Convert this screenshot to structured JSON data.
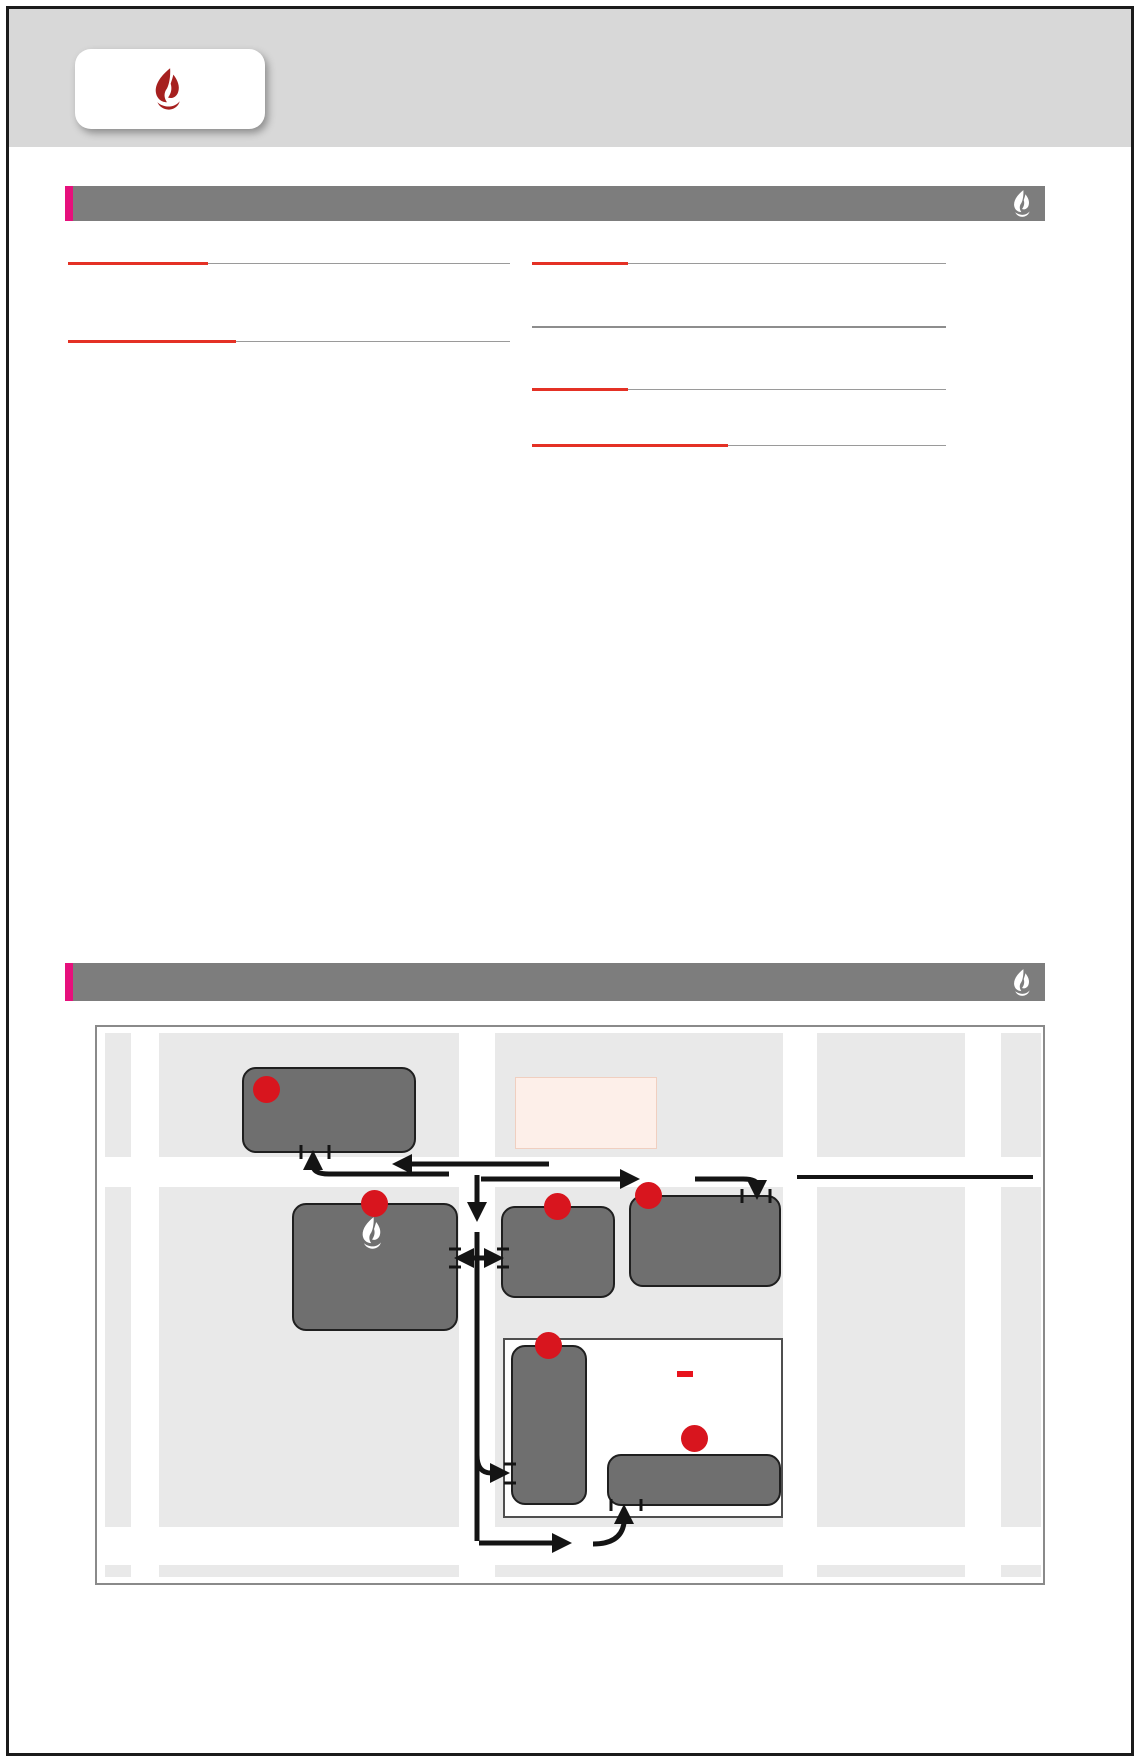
{
  "header": {
    "logo_text": "교회안내",
    "church_name": "LA SA-RANG COMMUNITY CHURCH"
  },
  "staff": {
    "title": "사역자 안내",
    "sep": "/",
    "left_groups": [
      {
        "heading": "장년사역",
        "rows": [
          {
            "name": "최금석 목사",
            "phone": "213-952-2405",
            "roles": "선임, 교구, 차세대총괄, 권사회, 선교, MTS"
          },
          {
            "name": "신범수 목사",
            "phone": "424-241-8239",
            "roles": "교구, 새가족, 훈련, 성경방, 주차/시설"
          },
          {
            "name": "황성실 목사",
            "phone": "213-235-8631",
            "roles": "교구, 실버, 찬양(대), 주방, 중보기도"
          },
          {
            "name": "김민기 목사",
            "phone": "714-497-7065",
            "roles": "대청부, 예배, 멀티미디어, LMD, 가정"
          },
          {
            "name": "김숙영 전도사",
            "phone": "909-802-0580",
            "roles": "교구, 에즈마이야, 새가족, 이웃사랑, 전도, Youth 디렉터"
          }
        ]
      },
      {
        "heading": "차세대사역",
        "rows": [
          {
            "name": "김크리스 전도사",
            "phone": "510-304-3968",
            "roles": "MTS, 에즈마이야, 고등부"
          },
          {
            "name": "조크리스 전도사",
            "phone": "503-810-8162",
            "roles": "MTS, 중등부"
          },
          {
            "name": "이옥희 전도사",
            "phone": "213-273-5534",
            "roles": "초등부, 학교총괄, CM디렉터"
          },
          {
            "name": "이희성 전도사",
            "phone": "213-999-1847",
            "roles": "유치부, 사랑토요한글/뮤직아트스쿨"
          },
          {
            "name": "송혜진 디렉터",
            "phone": "213-220-1853",
            "roles": "유아부"
          },
          {
            "name": "손이사야 전도사",
            "phone": "213-598-9987",
            "roles": "MTS, 차세대 인턴"
          },
          {
            "name": "한성준 전도사",
            "phone": "213-254-8592",
            "roles": "MTS, 차세대 인턴"
          }
        ]
      }
    ],
    "right_group": {
      "heading": "협동목사",
      "rows": [
        {
          "name": "이해룡 목사",
          "phone": "310-527-1488",
          "roles": "신학교사역"
        },
        {
          "name": "송성엽 목사",
          "phone": "213-370-7707",
          "roles": "가정, 커뮤니티"
        },
        {
          "name": "윤상운 목사",
          "phone": "213-378-7714",
          "roles": ""
        }
      ]
    },
    "retired": {
      "heading": "은퇴전도사",
      "name": "우완재 전도사",
      "phone": "213-248-1929"
    },
    "support": {
      "heading": "목회지원",
      "rows": [
        {
          "name": "이재영",
          "phone": "714-720-5113",
          "roles": "목지실, 사랑아카데미, 에즈마이야"
        },
        {
          "name": "전경희",
          "phone": "213-364-3939",
          "roles": "그래픽 디자인"
        },
        {
          "name": "박　준",
          "phone": "213-718-1445",
          "roles": "음향"
        }
      ]
    },
    "academy": {
      "heading": "LA사랑아카데미",
      "website": "www.MYsarang.com",
      "joiner": "–",
      "rows": [
        {
          "label": "학교 총괄 디렉터",
          "value": "이옥희 전도사  213-273-5534"
        },
        {
          "label": "토요한글학교 / 뮤직아트스쿨",
          "value": "이희성 전도사  213-999-1847"
        },
        {
          "label": "썸머/윈터/K~5 애프터스쿨",
          "value": "최영미 원장  323-652-0999"
        }
      ]
    }
  },
  "directions": {
    "title": "주일 예배 장소 오시는 길",
    "venue": "〈사랑올림픽센터〉",
    "address": "2610 W. Olympic Blvd., Los Angeles CA 90006",
    "corner_note": "(올림픽과 엘덴 코너)"
  },
  "map": {
    "streets": {
      "olympic": "Olympic Blvd",
      "elden": "Elden Ave",
      "vermont": "Vermont Ave",
      "hoover": "Hoover St",
      "eleventh": "11st ST."
    },
    "landmarks": {
      "tgi": "TGI BBQ",
      "school_line1": "Leo Politi",
      "school_line2": "Elementary School",
      "school_tag": "※ 시큐리티 상주"
    },
    "addr_labels": {
      "box4": "(2605 W. Olympic Bl.)",
      "box1": "(2610 W. Olympic Bl.)",
      "box2": "(2580 W. Olympic Bl.)",
      "box3": "(2560 W. Olympic Bl.)"
    },
    "boxes": {
      "b4": {
        "num": "4",
        "title": "에덴자동차 주차장",
        "lines": [
          "※ 주일 오전 6시 45분 ~",
          "오후1시 30분 (시큐리티 상주)"
        ]
      },
      "b1": {
        "num": "1",
        "title1": "LA사랑의교회",
        "title2": "주차장",
        "lines": [
          "※ OPEN",
          "<새가족, 시니어, 장애우,",
          "유모차동반차량 Only>"
        ]
      },
      "b2": {
        "num": "2",
        "title": "삼호관광",
        "lines": [
          "※ 주일 오전 7시 ~",
          "오전 11시까지 사용"
        ]
      },
      "b3": {
        "num": "3",
        "title1": "삼호관광 옆",
        "title2": "주차빌딩",
        "lines": [
          "(주일 오전 7시 ~ 오후 5시",
          "시큐리티 상주)"
        ]
      },
      "b5": {
        "num": "5",
        "bold_lines": [
          "Leo Politi",
          "초등학교",
          "주차장"
        ],
        "lines": [
          "<주일>",
          "8:45am ~",
          "1:30pm)"
        ]
      },
      "b6": {
        "num": "6",
        "title": "Leo Politi 초등학교 주차장",
        "line": "<주일> 8:45am ~ 1:30pm)"
      }
    }
  },
  "footer": {
    "title": "〈주차장 사용시간 안내〉",
    "bullet": "•",
    "lines": [
      {
        "entries": [
          {
            "badges": [
              "1"
            ],
            "label": "사랑올림픽센터 교회주차장 〈Open〉",
            "time": ""
          },
          {
            "badges": [
              "2"
            ],
            "label": "삼호관광 〈주일〉",
            "time": "오전 7시 ~ 오전 11시"
          }
        ]
      },
      {
        "entries": [
          {
            "badges": [
              "3"
            ],
            "label": "주차빌딩 〈주일〉",
            "time": "오전 7시 ~ 오후 5시"
          },
          {
            "badges": [
              "4"
            ],
            "label": "에덴자동차 〈주일〉",
            "time": "오전 6시 45분 ~ 오후 1시 30분 사용"
          }
        ]
      },
      {
        "entries": [
          {
            "badges": [
              "5",
              "6"
            ],
            "label": "Leo Politi 초등학교 주차장 〈주일〉",
            "time": "오전 8시 45분 ~ 오후 1시 30분"
          }
        ]
      }
    ]
  },
  "colors": {
    "header_gray": "#d8d8d8",
    "bar_gray": "#7d7d7d",
    "accent_magenta": "#e6107c",
    "brand_red": "#a6201f",
    "accent_red": "#e43125",
    "badge_red": "#d8151e",
    "map_box_gray": "#6f6f6f",
    "security_tag_red": "#e8131d"
  }
}
